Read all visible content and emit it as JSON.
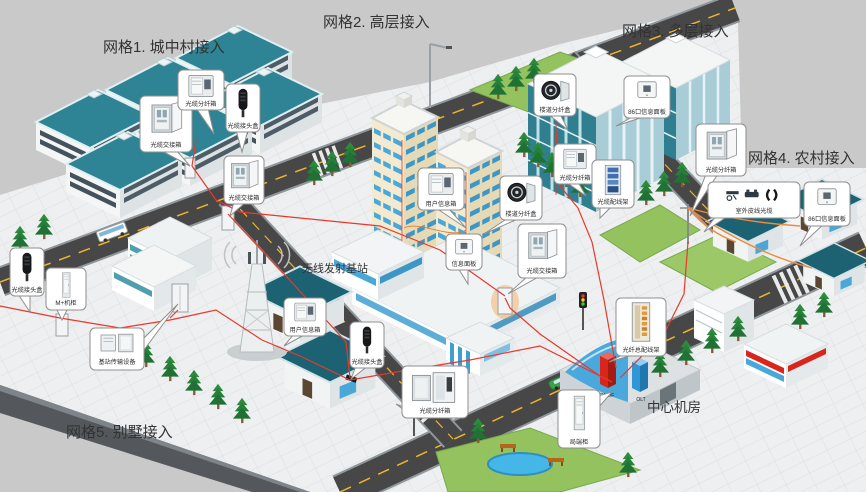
{
  "regions": {
    "grid1": {
      "label": "网格1. 城中村接入"
    },
    "grid2": {
      "label": "网格2. 高层接入"
    },
    "grid3": {
      "label": "网格3. 多层接入"
    },
    "grid4": {
      "label": "网格4. 农村接入"
    },
    "grid5": {
      "label": "网格5. 别墅接入"
    },
    "base_station": {
      "label": "无线发射基站"
    },
    "central_office": {
      "label": "中心机房"
    }
  },
  "central_office_equipment": {
    "red_rack_label": "OMDF",
    "blue_rack_label": "OLT"
  },
  "callouts": [
    {
      "id": "grid1-cross-cabinet",
      "label": "光缆交接箱"
    },
    {
      "id": "grid1-dist-box",
      "label": "光缆分纤箱"
    },
    {
      "id": "grid1-splice-closure",
      "label": "光缆接头盒"
    },
    {
      "id": "grid1-street-cabinet",
      "label": "光缆交接箱"
    },
    {
      "id": "grid2-user-info-box",
      "label": "用户信息箱"
    },
    {
      "id": "grid2-floor-dist-box",
      "label": "楼道分纤盒"
    },
    {
      "id": "grid2-info-panel",
      "label": "信息面板"
    },
    {
      "id": "grid2-cross-cabinet",
      "label": "光缆交接箱"
    },
    {
      "id": "grid3-floor-dist-box",
      "label": "楼道分纤盒"
    },
    {
      "id": "grid3-info-panel",
      "label": "86口信息面板"
    },
    {
      "id": "grid3-dist-box",
      "label": "光缆分纤箱"
    },
    {
      "id": "grid3-dist-frame",
      "label": "光缆配线架"
    },
    {
      "id": "grid4-dist-box",
      "label": "光缆分纤箱"
    },
    {
      "id": "grid4-drop-cable",
      "label": "室外皮线光缆"
    },
    {
      "id": "grid4-info-panel",
      "label": "86口信息面板"
    },
    {
      "id": "grid5-user-info-box",
      "label": "用户信息箱"
    },
    {
      "id": "grid5-splice-closure",
      "label": "光缆接头盒"
    },
    {
      "id": "grid5-dist-box",
      "label": "光缆分纤箱"
    },
    {
      "id": "bs-cabinet",
      "label": "M+机柜"
    },
    {
      "id": "bs-equipment",
      "label": "基站传输设备"
    },
    {
      "id": "bs-splice-closure",
      "label": "光缆接头盒"
    },
    {
      "id": "co-odf",
      "label": "光纤总配线架"
    },
    {
      "id": "co-cabinet",
      "label": "局端柜"
    }
  ],
  "colors": {
    "background": "#c9c9c9",
    "platform": "#eff1f2",
    "road": "#474747",
    "road_center_line": "#f0b429",
    "fiber_cable": "#e8392a",
    "drop_cable": "#f08a3c",
    "roof_teal": "#2e8494",
    "tower_cream": "#f3ead0",
    "window_blue": "#49a8d8",
    "lawn": "#93c25e",
    "pond": "#45b6e8",
    "rack_red": "#d9261c",
    "rack_blue": "#2f97d8"
  }
}
